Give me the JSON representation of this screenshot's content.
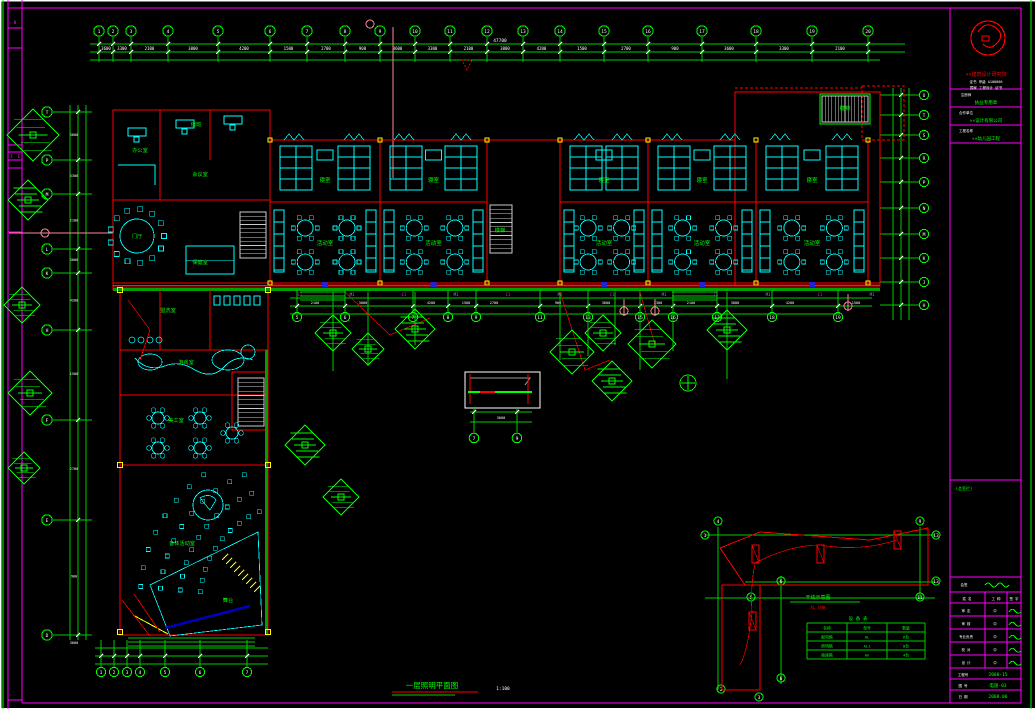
{
  "colors": {
    "bg": "#000000",
    "frame": "#ff00ff",
    "green": "#00ff00",
    "dim": "#00cc00",
    "band": "#00a000",
    "cyan": "#00ffff",
    "red": "#ff0000",
    "yellow": "#ffff00",
    "white": "#ffffff",
    "gray": "#9a9a9a",
    "violet": "#9f7fdf",
    "blue": "#2222dd",
    "navy": "#0000bb",
    "pink": "#ff8899",
    "stair": "#cccccc"
  },
  "footer": {
    "title": "一层照明平面图",
    "scale": "1:100"
  },
  "title_block": {
    "institute": "××建筑设计研究院",
    "cert1": "证书 甲级 A100000",
    "cert2": "国家 工程设计 证书",
    "rows": [
      {
        "label": "注册师",
        "value": "执业专用章"
      },
      {
        "label": "合作单位",
        "value": "××设计有限公司"
      },
      {
        "label": "工程名称",
        "value": "××幼儿园工程"
      }
    ],
    "sign_note": "(会签栏)",
    "table_header": [
      "姓 名",
      "工 种",
      "签 字"
    ],
    "sig_rows": [
      "审 定",
      "审 核",
      "专业负责",
      "校 对",
      "设 计"
    ],
    "footer_rows": [
      {
        "label": "工程号",
        "value": "2008-15"
      },
      {
        "label": "图 号",
        "value": "电施-03"
      },
      {
        "label": "日 期",
        "value": "2008.06"
      }
    ],
    "frame_letters": [
      "F",
      "E"
    ]
  },
  "grid": {
    "top": {
      "y": 31,
      "x": [
        99,
        113,
        131,
        168,
        218,
        270,
        307,
        345,
        380,
        415,
        450,
        487,
        523,
        560,
        604,
        648,
        702,
        756,
        812,
        868
      ],
      "labels": [
        "1",
        "2",
        "3",
        "4",
        "5",
        "6",
        "7",
        "8",
        "9",
        "10",
        "11",
        "12",
        "13",
        "14",
        "15",
        "16",
        "17",
        "18",
        "19",
        "20"
      ]
    },
    "left": {
      "x": 47,
      "y": [
        112,
        160,
        194,
        249,
        273,
        330,
        420,
        520,
        635
      ],
      "labels": [
        "T",
        "P",
        "M",
        "L",
        "K",
        "H",
        "F",
        "E",
        "D"
      ]
    },
    "right": {
      "x": 912,
      "y": [
        95,
        115,
        135,
        158,
        182,
        208,
        234,
        258,
        282,
        305
      ],
      "labels": [
        "U",
        "T",
        "S",
        "R",
        "P",
        "N",
        "M",
        "K",
        "J",
        "H"
      ]
    },
    "bottom_main": {
      "y": 317,
      "x": [
        297,
        345,
        413,
        448,
        476,
        540,
        588,
        640,
        673,
        717,
        772,
        838
      ],
      "labels": [
        "5",
        "6",
        "7",
        "8",
        "9",
        "11",
        "13",
        "15",
        "16",
        "17",
        "18",
        "19"
      ]
    },
    "bottom_left": {
      "y": 672,
      "x": [
        101,
        114,
        127,
        140,
        165,
        200,
        247
      ],
      "labels": [
        "1",
        "2",
        "3",
        "4",
        "5",
        "6",
        "7"
      ]
    },
    "detail": {
      "y": 438,
      "x": [
        474,
        517
      ],
      "labels": [
        "7",
        "9"
      ]
    }
  },
  "dims": [
    "3600",
    "3300",
    "2100",
    "3000",
    "4200",
    "1500",
    "2700",
    "900"
  ],
  "total_dim": "47700",
  "rooms": {
    "bedroom": "寝室",
    "activity": "活动室",
    "labels": [
      {
        "t": "门厅",
        "x": 137,
        "y": 238
      },
      {
        "t": "办公室",
        "x": 140,
        "y": 152
      },
      {
        "t": "值班",
        "x": 196,
        "y": 126
      },
      {
        "t": "会议室",
        "x": 200,
        "y": 176
      },
      {
        "t": "保健室",
        "x": 200,
        "y": 264
      },
      {
        "t": "盥洗室",
        "x": 168,
        "y": 312
      },
      {
        "t": "游戏室",
        "x": 186,
        "y": 364
      },
      {
        "t": "美工室",
        "x": 176,
        "y": 422
      },
      {
        "t": "音体活动室",
        "x": 182,
        "y": 545
      },
      {
        "t": "舞台",
        "x": 228,
        "y": 602
      },
      {
        "t": "楼梯",
        "x": 500,
        "y": 232
      },
      {
        "t": "楼梯",
        "x": 845,
        "y": 110
      }
    ]
  },
  "module_codes": [
    "C1",
    "M1",
    "C1",
    "M1",
    "C1",
    "M1",
    "C1",
    "M1",
    "C1",
    "M1",
    "C1",
    "M1"
  ],
  "keyplan": {
    "label": "干线示意图",
    "sub": "AL 总箱",
    "table_title": "设 备 表",
    "table": [
      [
        "名称",
        "型号",
        "数量"
      ],
      [
        "配电箱",
        "AL",
        "6台"
      ],
      [
        "照明箱",
        "AL1",
        "8台"
      ],
      [
        "插座箱",
        "AX",
        "4台"
      ]
    ],
    "bubbles": [
      "4",
      "9",
      "1",
      "13",
      "6",
      "13",
      "11",
      "5",
      "6",
      "2",
      "3"
    ]
  },
  "trees": [
    [
      33,
      135,
      26
    ],
    [
      28,
      200,
      20
    ],
    [
      22,
      305,
      18
    ],
    [
      30,
      393,
      22
    ],
    [
      24,
      468,
      16
    ],
    [
      305,
      445,
      20
    ],
    [
      341,
      497,
      18
    ],
    [
      333,
      333,
      18
    ],
    [
      368,
      349,
      16
    ],
    [
      415,
      329,
      20
    ],
    [
      572,
      352,
      22
    ],
    [
      603,
      333,
      18
    ],
    [
      612,
      381,
      20
    ],
    [
      652,
      344,
      24
    ],
    [
      727,
      330,
      20
    ]
  ]
}
